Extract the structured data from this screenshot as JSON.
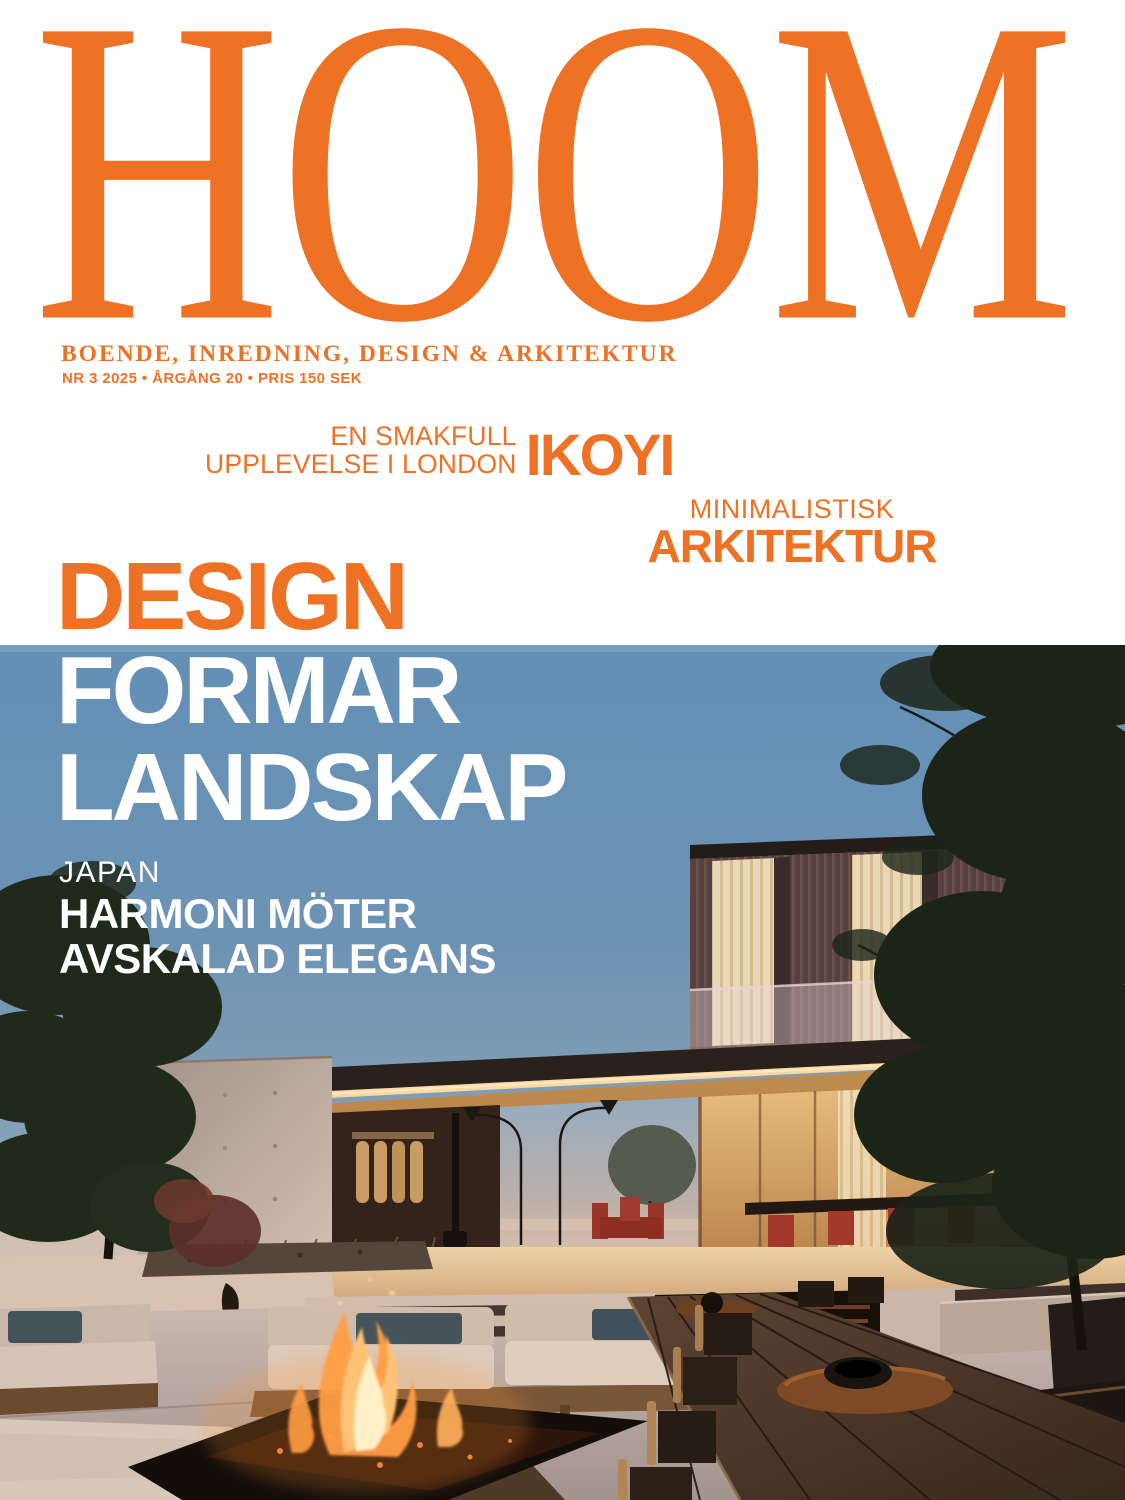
{
  "cover": {
    "masthead": "HOOM",
    "tagline": "BOENDE, INREDNING, DESIGN & ARKITEKTUR",
    "issue_line": "NR 3 2025 • ÅRGÅNG 20 • PRIS 150 SEK",
    "feature_london": {
      "kicker_line1": "EN SMAKFULL",
      "kicker_line2": "UPPLEVELSE I LONDON",
      "title": "IKOYI"
    },
    "feature_architecture": {
      "kicker": "MINIMALISTISK",
      "title": "ARKITEKTUR"
    },
    "main_feature": {
      "line1": "DESIGN",
      "line2": "FORMAR",
      "line3": "LANDSKAP"
    },
    "feature_japan": {
      "kicker": "JAPAN",
      "line1": "HARMONI MÖTER",
      "line2": "AVSKALAD ELEGANS"
    },
    "colors": {
      "accent_orange": "#EE7124",
      "headline_white": "#FFFFFF",
      "sky_top": "#5F89AE",
      "sky_horizon": "#CBB6AB"
    },
    "photo": {
      "description": "Modern minimalist house terrace at dusk with sunken lounge, fire pit and long wooden dining table"
    }
  }
}
